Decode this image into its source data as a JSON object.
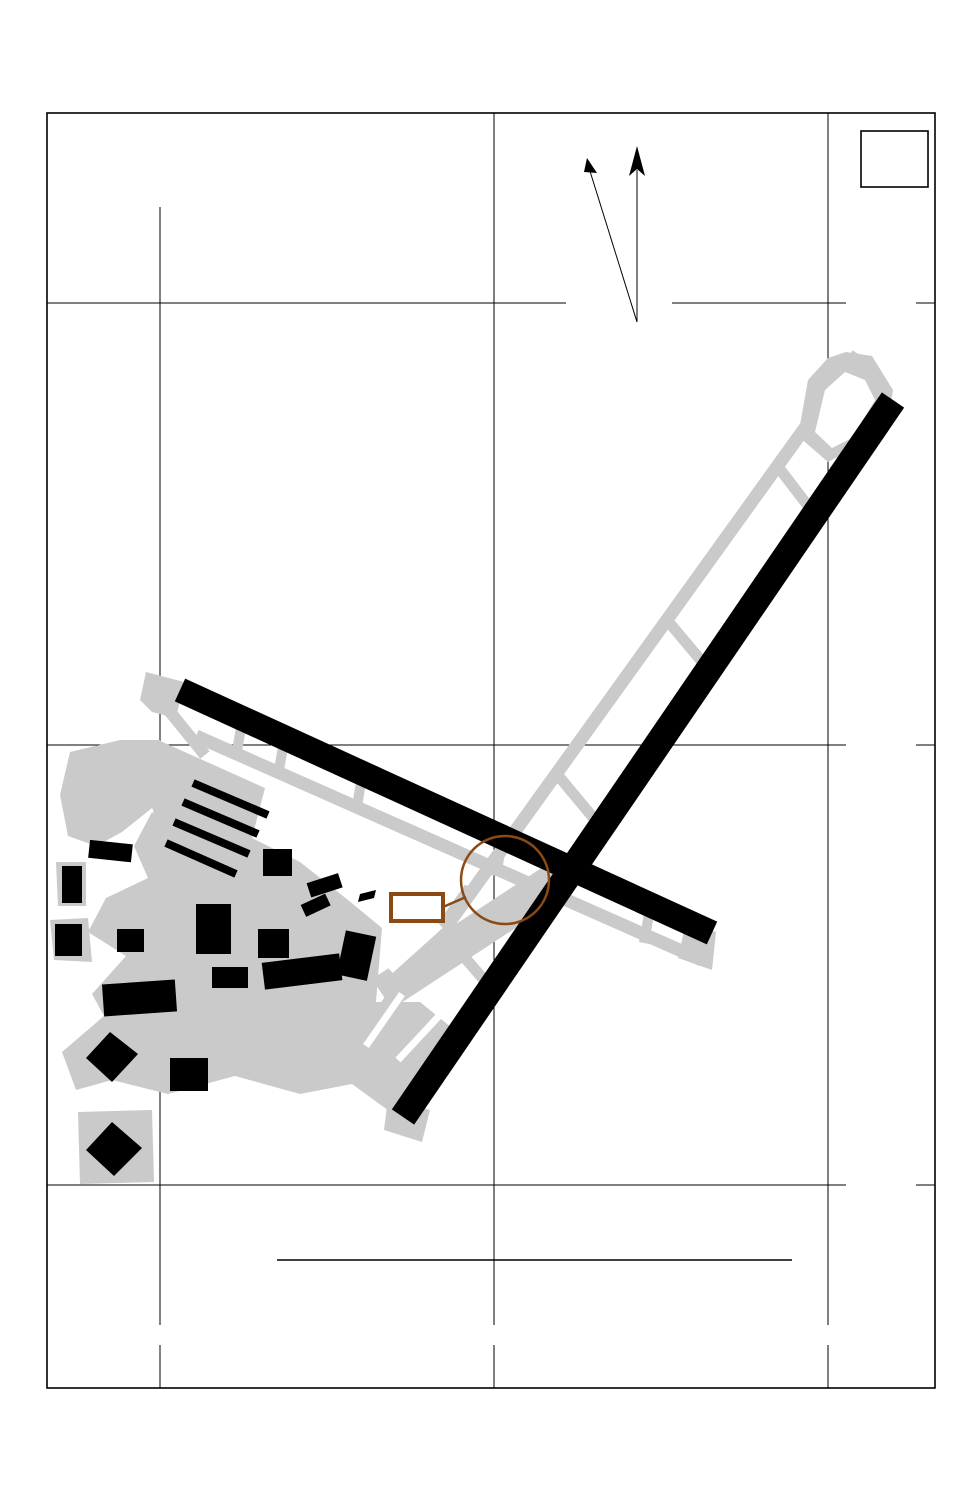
{
  "doc": {
    "chart_code": "26022",
    "title": "AIRPORT DIAGRAM",
    "al_ref": "AL-931 (FAA)",
    "airport_name": "MORRISTOWN MUNI",
    "airport_ident": "(MMU)",
    "city_state": "MORRISTOWN, NEW JERSEY",
    "edition": "NE-2,  16 APR 2026  to  14 MAY 2026"
  },
  "comm": {
    "lines": [
      "ATIS",
      "124.25",
      "MORRISTOWN TOWER",
      "118.1  353.9",
      "GND CON",
      "134.2",
      "CLNC DEL",
      "128.6"
    ]
  },
  "field_elev": {
    "line1": "FIELD",
    "line2": "ELEV",
    "value": "187"
  },
  "compass": {
    "variation": "VAR 12.4° W",
    "date": "JANUARY 2025",
    "rate_label": "ANNUAL RATE OF CHANGE",
    "rate_value": "0.0° E"
  },
  "grid": {
    "lat": [
      "40°48.5′N",
      "40°48.0′N",
      "40°47.5′N"
    ],
    "lon": [
      "74°25.5′W",
      "74°25.0′W",
      "74°24.5′W"
    ]
  },
  "runways": {
    "rwy_05_23": {
      "dim": "5998 X 150",
      "num_05": "5",
      "num_23": "23",
      "hdg_05": "048.5°",
      "hdg_23": "228.5°",
      "elev_label": "ELEV",
      "elev_05": "182",
      "elev_23": "183"
    },
    "rwy_13_31": {
      "dim": "3997 X 150",
      "num_13": "13",
      "num_31": "31",
      "hdg_13": "126.3°",
      "hdg_31": "306.3°",
      "elev_label": "ELEV",
      "elev_13": "187",
      "elev_31": "181"
    }
  },
  "features": {
    "west_tie_down": [
      "WEST",
      "TIE",
      "DOWN"
    ],
    "ga_parking": [
      "GENERAL",
      "AVIATION",
      "PARKING"
    ],
    "tower_label": "TWR",
    "tower_icon": "☆",
    "hot_spot_label": "HS 1",
    "hot_spot_color": "#8b4a14"
  },
  "taxiways": [
    "A",
    "A",
    "A",
    "H",
    "G",
    "F",
    "B",
    "B",
    "B",
    "B",
    "C",
    "C",
    "E",
    "R",
    "J",
    "D",
    "L",
    "M"
  ],
  "rwy_data": [
    "RWY 05-23",
    "PCN 25 F/C/X/T",
    "S-30, D-80",
    "RWY 13-31",
    "PCN 11 F/C/X/T",
    "S-30"
  ],
  "caution": [
    "CAUTION: BE ALERT TO RUNWAY CROSSING CLEARANCES.",
    "READBACK OF ALL RUNWAY HOLDING INSTRUCTIONS IS REQUIRED."
  ]
}
